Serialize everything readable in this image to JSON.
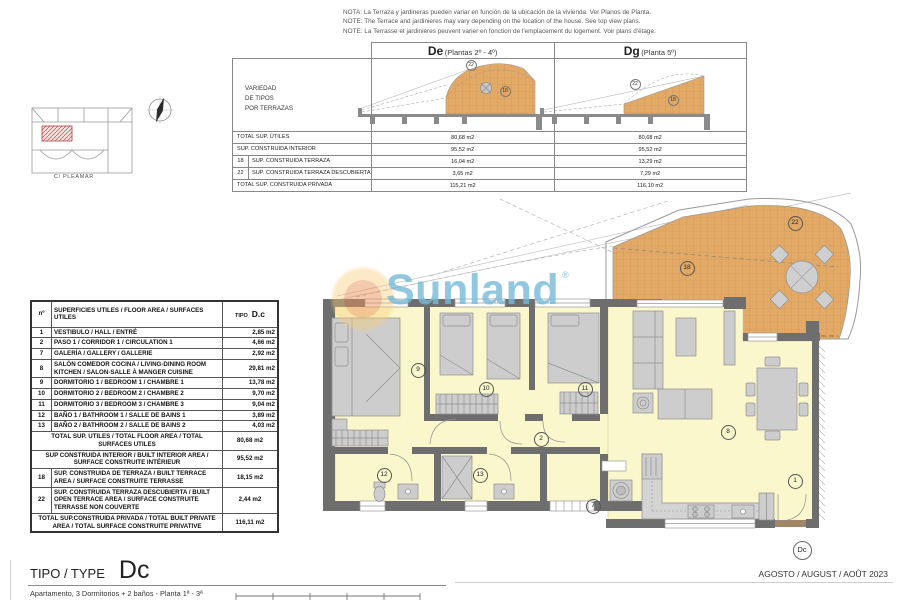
{
  "notes": {
    "line1": "NOTA: La Terraza y jardineras pueden variar en función de la ubicación de la vivienda. Ver Planos de Planta.",
    "line2": "NOTE: The Terrace and jardinieres may vary depending on the location of the house. See top view plans.",
    "line3": "NOTE: La Terrasse et jardinières peuvent varier en fonction de l'emplacement du logement. Voir plans d'étage."
  },
  "site_key": {
    "street": "C/ PLEAMAR"
  },
  "variant_table": {
    "side_label_lines": [
      "VARIEDAD",
      "DE TIPOS",
      "POR TERRAZAS"
    ],
    "columns": [
      {
        "code": "De",
        "subtitle": "(Plantas 2º - 4º)"
      },
      {
        "code": "Dg",
        "subtitle": "(Planta 5º)"
      }
    ],
    "sketch_labels": {
      "de": [
        "22",
        "18"
      ],
      "dg": [
        "22",
        "18"
      ]
    },
    "rows": [
      {
        "num": "",
        "label": "TOTAL SUP. ÚTILES",
        "de": "80,68 m2",
        "dg": "80,68 m2"
      },
      {
        "num": "",
        "label": "SUP. CONSTRUIDA INTERIOR",
        "de": "95,52 m2",
        "dg": "95,52 m2"
      },
      {
        "num": "18",
        "label": "SUP. CONSTRUIDA TERRAZA",
        "de": "16,04 m2",
        "dg": "13,29 m2"
      },
      {
        "num": "22",
        "label": "SUP. CONSTRUIDA TERRAZA DESCUBIERTA",
        "de": "3,65 m2",
        "dg": "7,29 m2"
      },
      {
        "num": "",
        "label": "TOTAL SUP. CONSTRUIDA PRIVADA",
        "de": "115,21 m2",
        "dg": "116,10 m2"
      }
    ]
  },
  "area_table": {
    "header": {
      "num": "nº",
      "label": "SUPERFICIES UTILES / FLOOR AREA / SURFACES UTILES",
      "tipo": "TIPO",
      "tipo_value": "D.c"
    },
    "rows": [
      {
        "num": "1",
        "label": "VESTIBULO / HALL / ENTRÉ",
        "value": "2,85 m2"
      },
      {
        "num": "2",
        "label": "PASO 1 / CORRIDOR 1 / CIRCULATION 1",
        "value": "4,66 m2"
      },
      {
        "num": "7",
        "label": "GALERÍA / GALLERY / GALLERIE",
        "value": "2,92 m2"
      },
      {
        "num": "8",
        "label": "SALÓN COMEDOR COCINA / LIVING-DINING ROOM KITCHEN / SALON-SALLE À MANGER CUISINE",
        "value": "29,81 m2"
      },
      {
        "num": "9",
        "label": "DORMITORIO 1 / BEDROOM 1 / CHAMBRE 1",
        "value": "13,78 m2"
      },
      {
        "num": "10",
        "label": "DORMITORIO 2 / BEDROOM 2 / CHAMBRE 2",
        "value": "9,70 m2"
      },
      {
        "num": "11",
        "label": "DORMITORIO 3 / BEDROOM 3 / CHAMBRE 3",
        "value": "9,04 m2"
      },
      {
        "num": "12",
        "label": "BAÑO 1 / BATHROOM 1 / SALLE DE BAINS 1",
        "value": "3,89 m2"
      },
      {
        "num": "13",
        "label": "BAÑO 2 / BATHROOM 2 / SALLE DE BAINS 2",
        "value": "4,03 m2"
      }
    ],
    "summary_rows": [
      {
        "num": "",
        "label": "TOTAL SUP. UTILES / TOTAL FLOOR AREA / TOTAL SURFACES UTILES",
        "value": "80,68 m2"
      },
      {
        "num": "",
        "label": "SUP CONSTRUIDA INTERIOR / BUILT INTERIOR AREA / SURFACE CONSTRUITE INTÉRIEUR",
        "value": "95,52 m2"
      },
      {
        "num": "18",
        "label": "SUP. CONSTRUIDA DE TERRAZA / BUILT TERRACE AREA / SURFACE CONSTRUITE TERRASSE",
        "value": "18,15 m2"
      },
      {
        "num": "22",
        "label": "SUP. CONSTRUIDA TERRAZA DESCUBIERTA / BUILT OPEN TERRACE AREA / SURFACE CONSTRUITE TERRASSE NON COUVERTE",
        "value": "2,44 m2"
      },
      {
        "num": "",
        "label": "TOTAL SUP.CONSTRUIDA PRIVADA / TOTAL BUILT PRIVATE AREA / TOTAL SURFACE CONSTRUITE PRIVATIVE",
        "value": "116,11 m2"
      }
    ]
  },
  "plan": {
    "markers": [
      "9",
      "10",
      "11",
      "2",
      "12",
      "13",
      "7",
      "8",
      "1",
      "18",
      "22"
    ],
    "unit_badge": "Dc"
  },
  "watermark": {
    "text": "Sunland",
    "reg": "®"
  },
  "footer": {
    "type_label": "TIPO / TYPE",
    "type_value": "Dc",
    "description": "Apartamento, 3 Dormitorios + 2 baños - Planta 1ª - 3ª",
    "date": "AGOSTO / AUGUST / AOÛT 2023",
    "colors": {
      "terrace": "#E3A966",
      "room_floor": "#FBF7CC",
      "wall": "#6e6e6e",
      "logo_blue": "#76BAD8"
    }
  }
}
